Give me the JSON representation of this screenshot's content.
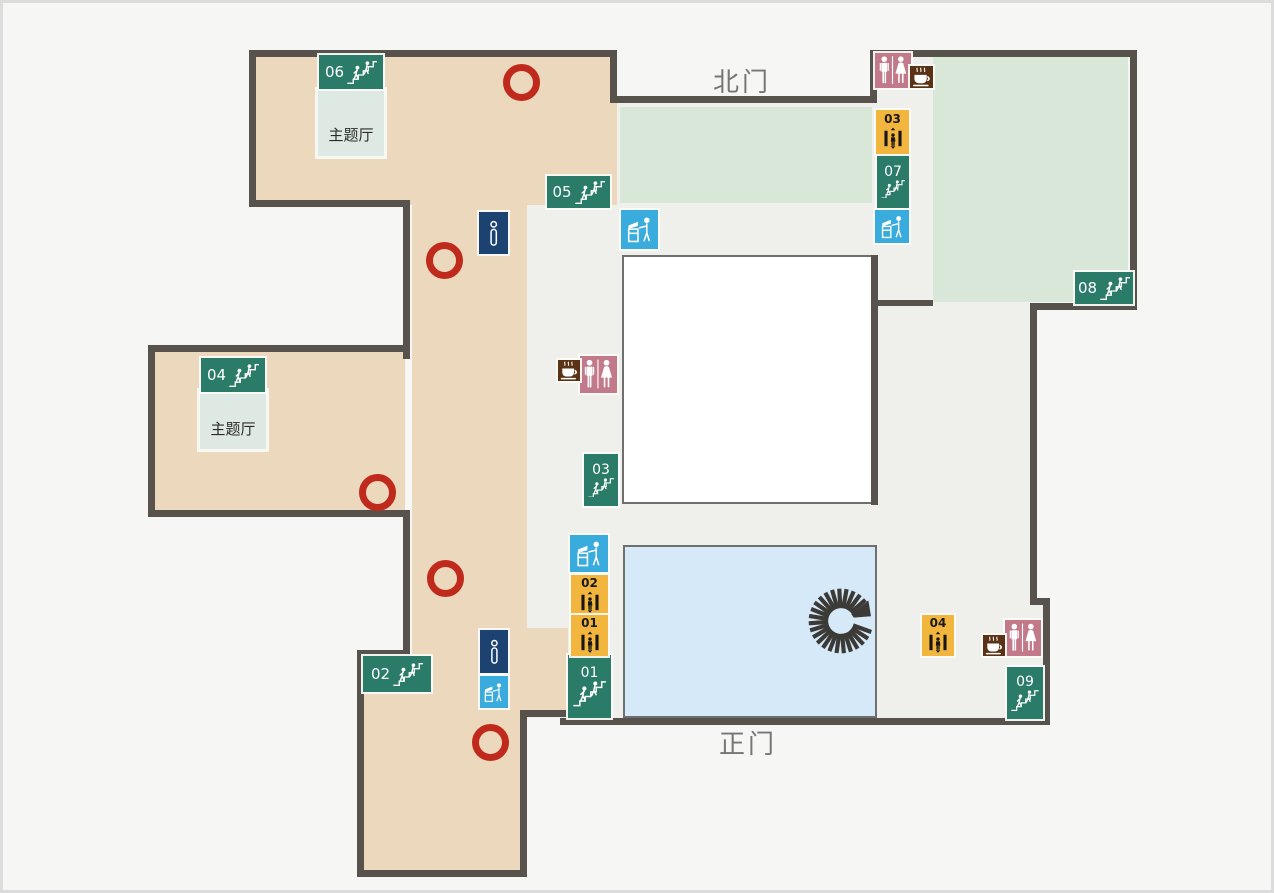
{
  "labels": {
    "north_gate": "北门",
    "main_gate": "正门",
    "theme_hall": "主题厅"
  },
  "colors": {
    "wall": "#57534c",
    "hall_floor": "#efefec",
    "exhibit_room_beige": "#ecd9bd",
    "exhibit_room_green": "#d8e7d7",
    "atrium_white": "#ffffff",
    "pool_blue": "#d5e9f8",
    "stairs": "#2b7b69",
    "elevator": "#f2b53d",
    "toilet": "#c2798a",
    "coffee": "#5a3317",
    "info": "#1c4271",
    "kiosk": "#3aabdd",
    "marker_red": "#c02a1c",
    "spiral_dark": "#3b3a37",
    "gate_text": "#757575",
    "theme_hall_box": "#dfe9e3"
  },
  "icons": {
    "stairs": "stairs-icon",
    "elevator": "elevator-icon",
    "toilet": "restroom-icon",
    "coffee": "cafe-icon",
    "info": "information-icon",
    "kiosk": "service-kiosk-icon",
    "spiral": "spiral-staircase-icon",
    "circle": "red-circle-marker"
  },
  "markers": [
    {
      "kind": "stairs",
      "variant": "h",
      "label": "06",
      "x": 319,
      "y": 55,
      "w": 64,
      "h": 34
    },
    {
      "kind": "stairs",
      "variant": "h",
      "label": "05",
      "x": 547,
      "y": 176,
      "w": 63,
      "h": 32
    },
    {
      "kind": "stairs",
      "variant": "h",
      "label": "04",
      "x": 201,
      "y": 358,
      "w": 64,
      "h": 34
    },
    {
      "kind": "stairs",
      "variant": "h",
      "label": "02",
      "x": 363,
      "y": 656,
      "w": 68,
      "h": 36
    },
    {
      "kind": "stairs",
      "variant": "h",
      "label": "08",
      "x": 1075,
      "y": 272,
      "w": 58,
      "h": 32
    },
    {
      "kind": "stairs",
      "variant": "v",
      "label": "07",
      "x": 877,
      "y": 155,
      "w": 32,
      "h": 53
    },
    {
      "kind": "stairs",
      "variant": "v",
      "label": "03",
      "x": 584,
      "y": 454,
      "w": 34,
      "h": 52
    },
    {
      "kind": "stairs",
      "variant": "v",
      "label": "01",
      "x": 568,
      "y": 655,
      "w": 43,
      "h": 63
    },
    {
      "kind": "stairs",
      "variant": "v",
      "label": "09",
      "x": 1007,
      "y": 667,
      "w": 36,
      "h": 52
    },
    {
      "kind": "elevator",
      "label": "03",
      "x": 876,
      "y": 110,
      "w": 33,
      "h": 44
    },
    {
      "kind": "elevator",
      "label": "02",
      "x": 571,
      "y": 575,
      "w": 37,
      "h": 41
    },
    {
      "kind": "elevator",
      "label": "01",
      "x": 571,
      "y": 615,
      "w": 37,
      "h": 41
    },
    {
      "kind": "elevator",
      "label": "04",
      "x": 922,
      "y": 615,
      "w": 32,
      "h": 41
    },
    {
      "kind": "toilet",
      "x": 875,
      "y": 53,
      "w": 36,
      "h": 35
    },
    {
      "kind": "toilet",
      "x": 580,
      "y": 356,
      "w": 37,
      "h": 37
    },
    {
      "kind": "toilet",
      "x": 1005,
      "y": 620,
      "w": 36,
      "h": 36
    },
    {
      "kind": "coffee",
      "x": 910,
      "y": 66,
      "w": 23,
      "h": 22
    },
    {
      "kind": "coffee",
      "x": 558,
      "y": 360,
      "w": 22,
      "h": 21
    },
    {
      "kind": "coffee",
      "x": 983,
      "y": 635,
      "w": 22,
      "h": 21
    },
    {
      "kind": "info",
      "x": 479,
      "y": 212,
      "w": 29,
      "h": 42
    },
    {
      "kind": "info",
      "x": 480,
      "y": 630,
      "w": 28,
      "h": 43
    },
    {
      "kind": "kiosk",
      "x": 621,
      "y": 210,
      "w": 37,
      "h": 39
    },
    {
      "kind": "kiosk",
      "x": 875,
      "y": 210,
      "w": 34,
      "h": 33
    },
    {
      "kind": "kiosk",
      "x": 570,
      "y": 535,
      "w": 38,
      "h": 37
    },
    {
      "kind": "kiosk",
      "x": 480,
      "y": 676,
      "w": 28,
      "h": 32
    }
  ],
  "circles": [
    {
      "cx": 521,
      "cy": 82
    },
    {
      "cx": 444,
      "cy": 260
    },
    {
      "cx": 377,
      "cy": 492
    },
    {
      "cx": 445,
      "cy": 578
    },
    {
      "cx": 490,
      "cy": 742
    }
  ]
}
